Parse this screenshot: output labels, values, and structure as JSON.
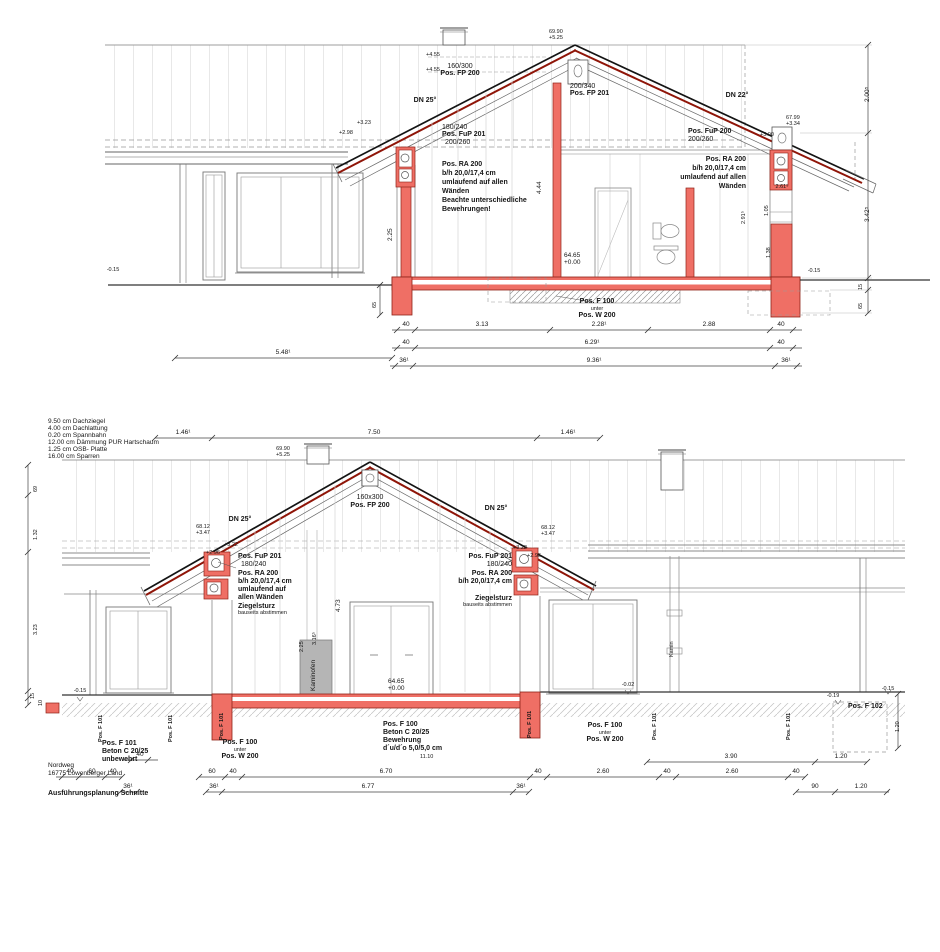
{
  "colors": {
    "structure_red": "#ef6f65",
    "structure_red_border": "#8f2318",
    "roof_line_red": "#8f1508",
    "hatch_gray": "#9a9a9a",
    "stripe_gray": "#c6c6c6"
  },
  "project": {
    "address_line1": "Nordweg",
    "address_line2": "16775 Löwenberger Land",
    "drawing_title": "Ausführungsplanung Schnitte"
  },
  "legend": {
    "rows": [
      "9.50 cm  Dachziegel",
      "4.00 cm  Dachlattung",
      "0.20 cm  Spannbahn",
      "12.00 cm  Dämmung PUR Hartschaum",
      "1.25 cm  OSB- Platte",
      "16.00 cm  Sparren"
    ]
  },
  "s1": {
    "ridge_elev": {
      "abs": "69.90",
      "rel": "+5.25"
    },
    "roof_pitch_left": "DN 25°",
    "roof_pitch_right": "DN 22°",
    "fp200": {
      "dim": "160/300",
      "label": "Pos. FP 200"
    },
    "fp201": {
      "dim": "200/340",
      "label": "Pos. FP 201"
    },
    "fup201": {
      "label": "Pos. FuP 201",
      "dim1": "180/240",
      "dim2": "200/260"
    },
    "ra200_left": [
      "Pos. RA 200",
      "b/h 20,0/17,4 cm",
      "umlaufend auf allen",
      "Wänden",
      "Beachte unterschiedliche",
      "Bewehrungen!"
    ],
    "fup200": {
      "label": "Pos. FuP 200",
      "dim": "200/260"
    },
    "ra200_right": [
      "Pos. RA 200",
      "b/h 20,0/17,4 cm",
      "umlaufend auf allen",
      "Wänden"
    ],
    "levels": {
      "l455a": "+4.55",
      "l455b": "+4.55",
      "l323": "+3.23",
      "l298": "+2.98",
      "eave_abs": "67.99",
      "eave_rel": "+3.34",
      "l300": "+3.00",
      "floor_abs": "64.65",
      "floor_rel": "+0.00",
      "ground_left": "-0.15",
      "ground_right": "-0.15"
    },
    "f100": {
      "line1": "Pos. F 100",
      "line2": "unter",
      "line3": "Pos. W 200"
    },
    "vdims": {
      "v444": "4.44",
      "v225": "2.25",
      "v2915": "2.91⁵",
      "v105": "1.05",
      "v138": "1.38",
      "v2615": "2.61⁵",
      "right1": "2.00⁵",
      "right2": "3.42⁵",
      "right3": "15",
      "right4": "65",
      "left65": "65"
    },
    "hdims": {
      "row1": [
        "40",
        "3.13",
        "2.28¹",
        "2.88",
        "40"
      ],
      "row2": [
        "40",
        "6.29¹",
        "40"
      ],
      "row3": [
        "5.48¹",
        "36¹",
        "9.36¹",
        "36¹"
      ]
    }
  },
  "s2": {
    "chimney_elev": {
      "abs": "69.90",
      "rel": "+5.25"
    },
    "roof_pitch_left": "DN 25°",
    "roof_pitch_right": "DN 25°",
    "fp200": {
      "dim": "160x300",
      "label": "Pos. FP 200"
    },
    "anno_left": [
      "Pos. FuP 201",
      "180/240",
      "Pos. RA 200",
      "b/h 20,0/17,4 cm",
      "umlaufend auf",
      "allen Wänden",
      "Ziegelsturz",
      "bauseits abstimmen"
    ],
    "anno_right": [
      "Pos. FuP 201",
      "180/240",
      "Pos. RA 200",
      "b/h 20,0/17,4 cm",
      "Ziegelsturz",
      "bauseits abstimmen"
    ],
    "eave_left": {
      "abs": "68.12",
      "rel": "+3.47",
      "l322": "+3.22",
      "l296": "+2.96"
    },
    "eave_right": {
      "abs": "68.12",
      "rel": "+3.47",
      "l322": "+3.22",
      "l296": "+2.96"
    },
    "kaminofen": "Kaminofen",
    "kamin": "Kamin",
    "levels": {
      "floor_abs": "64.65",
      "floor_rel": "+0.00",
      "gl": "-0.15",
      "g02": "-0.02",
      "g19": "-0.19",
      "gr": "-0.15"
    },
    "f101_block": [
      "Pos. F 101",
      "Beton C 20/25",
      "unbewehrt"
    ],
    "f100_left": [
      "Pos. F 100",
      "unter",
      "Pos. W 200"
    ],
    "f100_center": [
      "Pos. F 100",
      "Beton C 20/25",
      "Bewehrung",
      "d´u/d´o 5,0/5,0 cm",
      "11.10"
    ],
    "f100_right": [
      "Pos. F 100",
      "unter",
      "Pos. W 200"
    ],
    "f101_v": "Pos. F 101",
    "f102": "Pos. F 102",
    "vdims": {
      "v473": "4.73",
      "v225": "2.25",
      "v3165": "3.16⁵",
      "left0": "69",
      "left1": "1.32",
      "left2": "3.23",
      "left3": "15",
      "left4": "10",
      "right120": "1.20"
    },
    "hdims": {
      "top": [
        "1.46¹",
        "7.50",
        "1.46¹"
      ],
      "row1": [
        "40",
        "3.90",
        "1.20"
      ],
      "row2": [
        "40",
        "60",
        "40",
        "60",
        "40",
        "6.70",
        "40",
        "2.60",
        "40",
        "2.60",
        "40"
      ],
      "row3": [
        "36¹",
        "36¹",
        "6.77",
        "36¹",
        "90",
        "1.20"
      ]
    }
  }
}
